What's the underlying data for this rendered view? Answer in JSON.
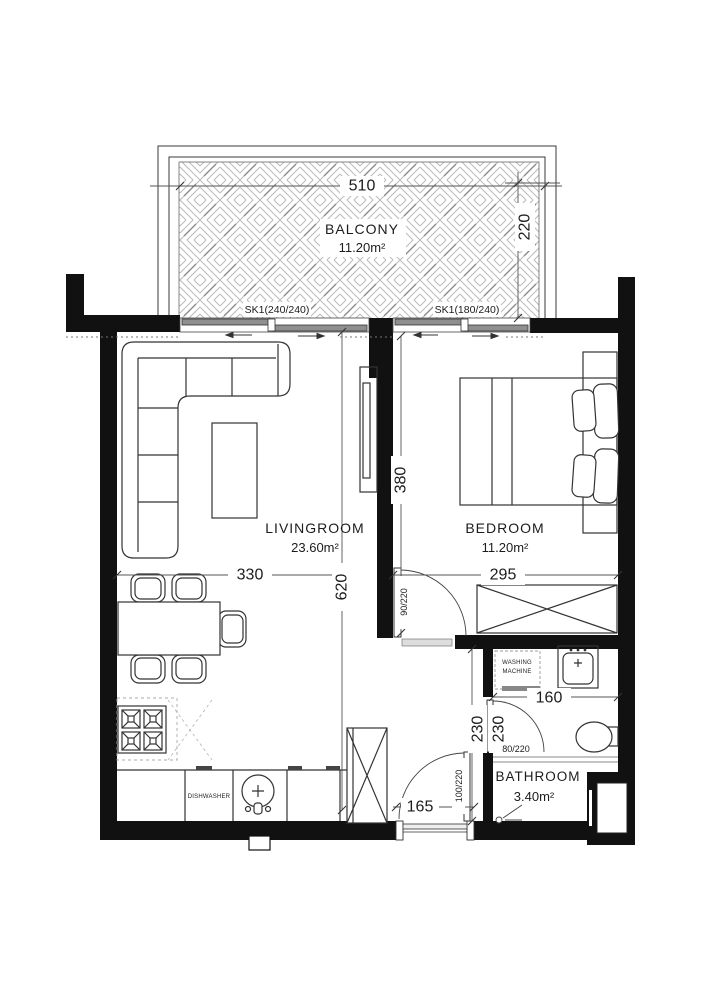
{
  "plan": {
    "rooms": {
      "balcony": {
        "name": "BALCONY",
        "area": "11.20m²"
      },
      "livingroom": {
        "name": "LIVINGROOM",
        "area": "23.60m²"
      },
      "bedroom": {
        "name": "BEDROOM",
        "area": "11.20m²"
      },
      "bathroom": {
        "name": "BATHROOM",
        "area": "3.40m²"
      }
    },
    "dimensions": {
      "balcony_width": "510",
      "balcony_depth": "220",
      "living_width": "330",
      "living_height": "620",
      "bedroom_width": "295",
      "bedroom_depth": "380",
      "bath_width": "160",
      "hall_height": "230",
      "bath_height": "230",
      "entry_width": "165"
    },
    "doors": {
      "bedroom_door": "90/220",
      "bathroom_door": "80/220",
      "entrance_door": "100/220"
    },
    "windows": {
      "living_window": "SK1(240/240)",
      "bedroom_window": "SK1(180/240)"
    },
    "labels": {
      "dishwasher": "DISHWASHER",
      "washing_line1": "WASHING",
      "washing_line2": "MACHINE",
      "shaft_line1": "H.B",
      "shaft_line2": "T.B"
    },
    "colors": {
      "wall": "#111111",
      "furniture_line": "#333333",
      "hatch": "#bdbdbd",
      "window_panel": "#8f8f8f"
    }
  }
}
